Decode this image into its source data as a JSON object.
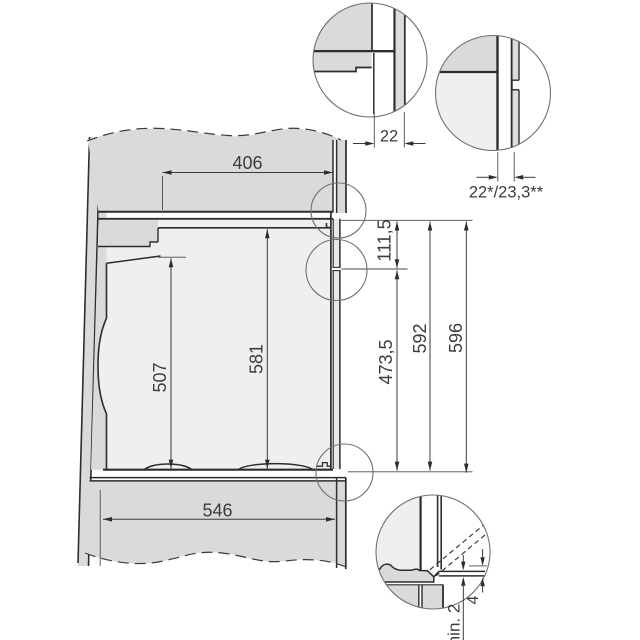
{
  "drawing": {
    "dims": {
      "top_depth": "406",
      "top_trim": "22",
      "front_panel": "22*/23,3**",
      "front_upper": "111,5",
      "front_lower": "473,5",
      "niche_front": "592",
      "front_total": "596",
      "cutout": "507",
      "interior": "581",
      "base_depth": "546",
      "door_gap": "min. 2",
      "trim_offset": "4"
    },
    "colors": {
      "panel_fill": "#d9dbda",
      "interior_fill": "#eef0ef",
      "line": "#2d2d2d",
      "dimension_line": "#3a3a3a",
      "background": "#ffffff"
    }
  }
}
